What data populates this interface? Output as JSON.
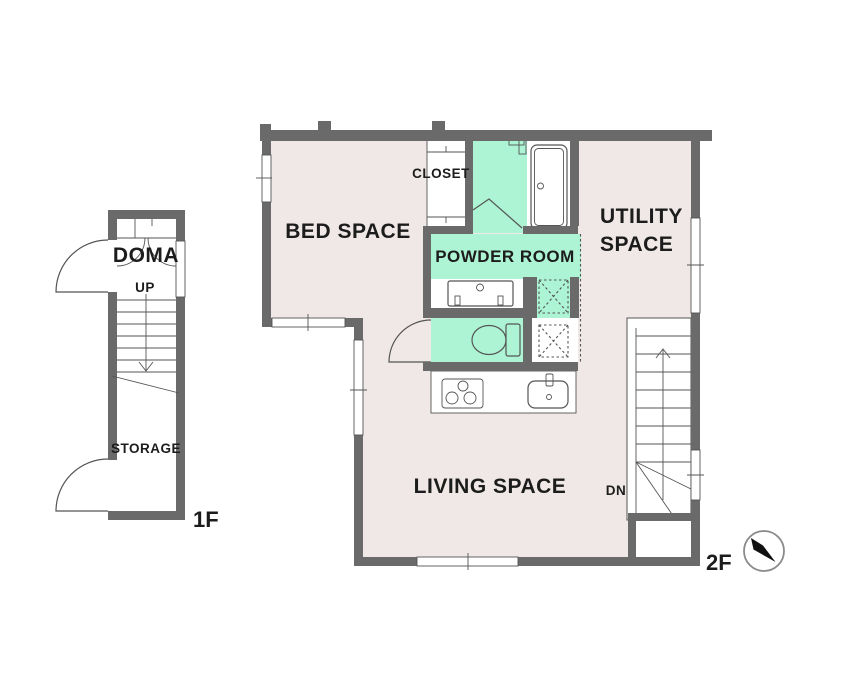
{
  "colors": {
    "wall_gray": "#6A6A6A",
    "floor_fill_pink": "#EFE8E6",
    "wet_area_fill_mint": "#ACF4D4",
    "detail_line": "#555555"
  },
  "floor_1f": {
    "tag": "1F",
    "doma_label": "DOMA",
    "up_label": "UP",
    "storage_label": "STORAGE"
  },
  "floor_2f": {
    "tag": "2F",
    "bed_label": "BED SPACE",
    "closet_label": "CLOSET",
    "powder_label": "POWDER ROOM",
    "utility_label_line1": "UTILITY",
    "utility_label_line2": "SPACE",
    "living_label": "LIVING SPACE",
    "dn_label": "DN"
  }
}
